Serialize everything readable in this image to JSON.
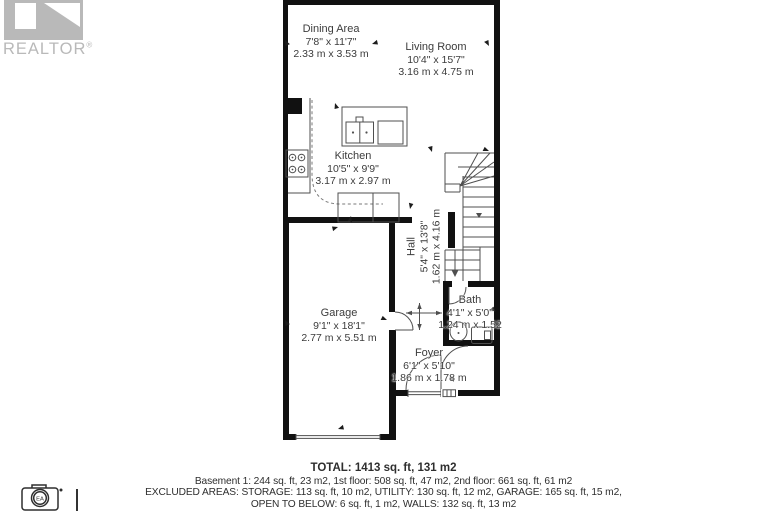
{
  "branding": {
    "logo_text": "REALTOR",
    "registered_mark": "®",
    "photo_credit_initials": "EA"
  },
  "rooms": {
    "dining": {
      "name": "Dining Area",
      "imperial": "7'8\" x 11'7\"",
      "metric": "2.33 m x 3.53 m"
    },
    "living": {
      "name": "Living Room",
      "imperial": "10'4\" x 15'7\"",
      "metric": "3.16 m x 4.75 m"
    },
    "kitchen": {
      "name": "Kitchen",
      "imperial": "10'5\" x 9'9\"",
      "metric": "3.17 m x 2.97 m"
    },
    "hall": {
      "name": "Hall",
      "imperial": "5'4\" x 13'8\"",
      "metric": "1.62 m x 4.16 m"
    },
    "garage": {
      "name": "Garage",
      "imperial": "9'1\" x 18'1\"",
      "metric": "2.77 m x 5.51 m"
    },
    "bath": {
      "name": "Bath",
      "imperial": "4'1\" x 5'0\"",
      "metric": "1.24 m x 1.52"
    },
    "foyer": {
      "name": "Foyer",
      "imperial": "6'1\" x 5'10\"",
      "metric": "1.86 m x 1.78 m"
    }
  },
  "summary": {
    "total": "TOTAL: 1413 sq. ft, 131 m2",
    "floor_breakdown": "Basement 1: 244 sq. ft, 23 m2, 1st floor: 508 sq. ft, 47 m2, 2nd floor: 661 sq. ft, 61 m2",
    "excluded_line1": "EXCLUDED AREAS: STORAGE: 113 sq. ft, 10 m2, UTILITY: 130 sq. ft, 12 m2, GARAGE: 165 sq. ft, 15 m2,",
    "excluded_line2": "OPEN TO BELOW: 6 sq. ft, 1 m2, WALLS: 132 sq. ft, 13 m2"
  },
  "colors": {
    "wall": "#111111",
    "linework": "#4f4f4f",
    "label_text": "#3c3c3c",
    "summary_text": "#2e2e2e",
    "logo_gray": "#b9b9b9"
  }
}
